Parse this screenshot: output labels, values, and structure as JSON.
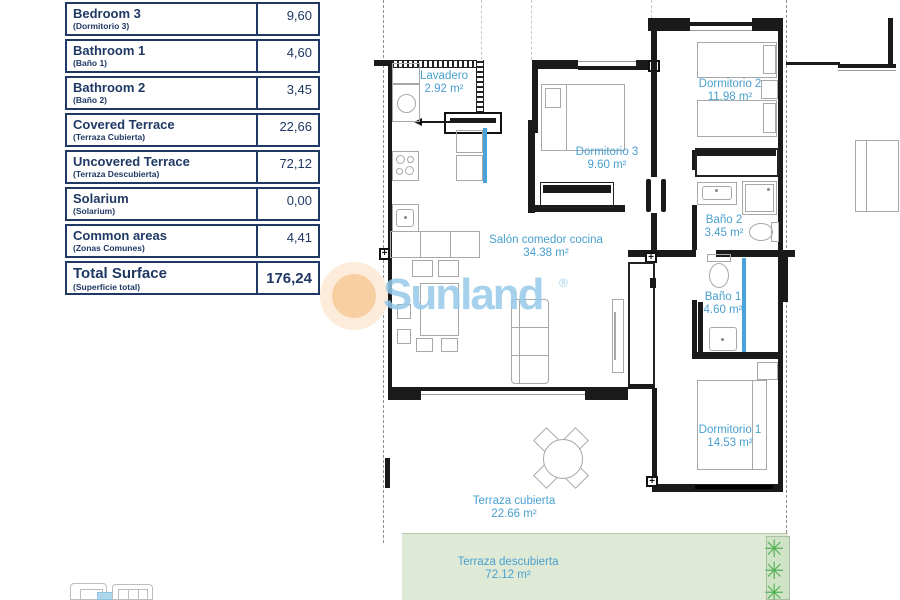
{
  "surface_table": {
    "rows": [
      {
        "en": "Bedroom 3",
        "es": "(Dormitorio 3)",
        "value": "9,60"
      },
      {
        "en": "Bathroom 1",
        "es": "(Baño 1)",
        "value": "4,60"
      },
      {
        "en": "Bathroom 2",
        "es": "(Baño 2)",
        "value": "3,45"
      },
      {
        "en": "Covered Terrace",
        "es": "(Terraza Cubierta)",
        "value": "22,66"
      },
      {
        "en": "Uncovered Terrace",
        "es": "(Terraza Descubierta)",
        "value": "72,12"
      },
      {
        "en": "Solarium",
        "es": "(Solarium)",
        "value": "0,00"
      },
      {
        "en": "Common areas",
        "es": "(Zonas Comunes)",
        "value": "4,41"
      }
    ],
    "total": {
      "en": "Total Surface",
      "es": "(Superficie total)",
      "value": "176,24"
    }
  },
  "floorplan": {
    "rooms": {
      "lavadero": {
        "name": "Lavadero",
        "area": "2.92 m²"
      },
      "dorm3": {
        "name": "Dormitorio 3",
        "area": "9.60 m²"
      },
      "dorm2": {
        "name": "Dormitorio 2",
        "area": "11.98 m²"
      },
      "bano2": {
        "name": "Baño 2",
        "area": "3.45 m²"
      },
      "salon": {
        "name": "Salón comedor cocina",
        "area": "34.38 m²"
      },
      "bano1": {
        "name": "Baño 1",
        "area": "4.60 m²"
      },
      "dorm1": {
        "name": "Dormitorio 1",
        "area": "14.53 m²"
      },
      "terraza_cubierta": {
        "name": "Terraza cubierta",
        "area": "22.66 m²"
      },
      "terraza_descubierta": {
        "name": "Terraza descubierta",
        "area": "72.12 m²"
      }
    }
  },
  "watermark": {
    "brand": "Sunland",
    "registered": "®"
  },
  "icons": {
    "plus": "+",
    "plant": "✳"
  },
  "colors": {
    "table_navy": "#1f3864",
    "room_label_blue": "#4aa0d0",
    "terrace_green": "#dfead6",
    "plant_green": "#57b257",
    "watermark_blue": "#97c9e9",
    "sun_orange": "#f8cfa0",
    "shower_blue": "#4aa3d8"
  }
}
